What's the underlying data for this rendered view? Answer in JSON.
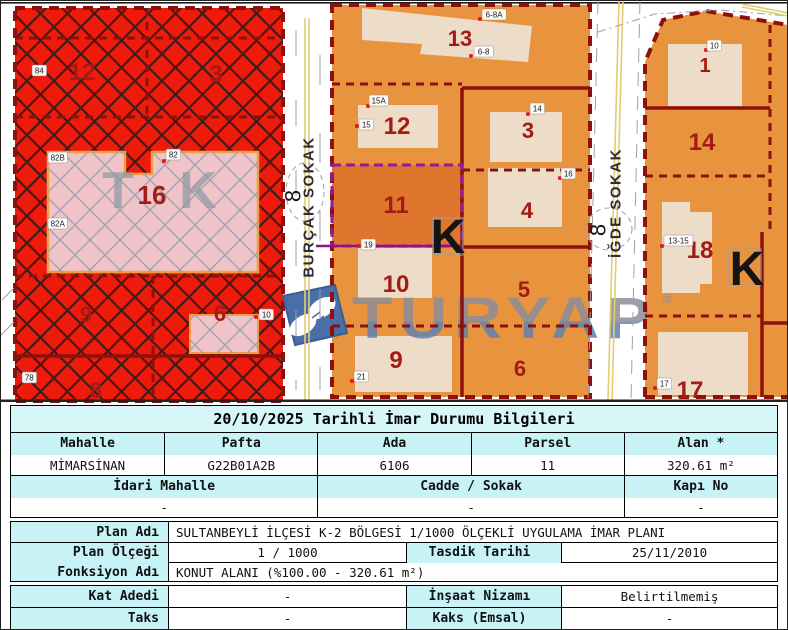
{
  "map": {
    "streets": [
      {
        "name": "BURÇAK SOKAK",
        "number": "8"
      },
      {
        "name": "İĞDE SOKAK",
        "number": "8"
      }
    ],
    "watermark": {
      "text": "TURYAP",
      "reg": "®"
    },
    "zone_letters": [
      {
        "t": "K",
        "x": 448,
        "y": 253,
        "s": 48,
        "c": "#141414",
        "o": 1
      },
      {
        "t": "K",
        "x": 747,
        "y": 285,
        "s": 48,
        "c": "#141414",
        "o": 1
      },
      {
        "t": "T",
        "x": 118,
        "y": 208,
        "s": 52,
        "c": "#8d97a3",
        "o": 0.7
      },
      {
        "t": "K",
        "x": 198,
        "y": 208,
        "s": 52,
        "c": "#8d97a3",
        "o": 0.7
      }
    ],
    "parcel_labels": [
      {
        "t": "12",
        "x": 82,
        "y": 80,
        "s": 24
      },
      {
        "t": "3",
        "x": 216,
        "y": 82,
        "s": 24
      },
      {
        "t": "16",
        "x": 152,
        "y": 204,
        "s": 26
      },
      {
        "t": "9",
        "x": 86,
        "y": 322,
        "s": 22
      },
      {
        "t": "6",
        "x": 220,
        "y": 321,
        "s": 22
      },
      {
        "t": "8",
        "x": 96,
        "y": 398,
        "s": 22
      },
      {
        "t": "13",
        "x": 460,
        "y": 46,
        "s": 22
      },
      {
        "t": "12",
        "x": 397,
        "y": 134,
        "s": 24
      },
      {
        "t": "3",
        "x": 528,
        "y": 138,
        "s": 22
      },
      {
        "t": "11",
        "x": 396,
        "y": 213,
        "s": 24
      },
      {
        "t": "4",
        "x": 527,
        "y": 218,
        "s": 22
      },
      {
        "t": "10",
        "x": 396,
        "y": 292,
        "s": 24
      },
      {
        "t": "5",
        "x": 524,
        "y": 297,
        "s": 22
      },
      {
        "t": "9",
        "x": 396,
        "y": 368,
        "s": 24
      },
      {
        "t": "6",
        "x": 520,
        "y": 376,
        "s": 22
      },
      {
        "t": "1",
        "x": 705,
        "y": 72,
        "s": 20
      },
      {
        "t": "14",
        "x": 702,
        "y": 150,
        "s": 24
      },
      {
        "t": "18",
        "x": 700,
        "y": 258,
        "s": 24
      },
      {
        "t": "17",
        "x": 690,
        "y": 398,
        "s": 24
      }
    ],
    "address_points": [
      {
        "t": "84",
        "x": 32,
        "y": 65
      },
      {
        "t": "82B",
        "x": 48,
        "y": 152
      },
      {
        "t": "82",
        "x": 166,
        "y": 149,
        "dot": [
          164,
          161
        ]
      },
      {
        "t": "82A",
        "x": 48,
        "y": 218
      },
      {
        "t": "78",
        "x": 22,
        "y": 372,
        "dot": [
          19,
          382
        ]
      },
      {
        "t": "10",
        "x": 259,
        "y": 309,
        "dot": [
          256,
          317
        ]
      },
      {
        "t": "6-8A",
        "x": 482,
        "y": 9,
        "dot": [
          480,
          19
        ]
      },
      {
        "t": "6-8",
        "x": 474,
        "y": 46,
        "dot": [
          471,
          56
        ]
      },
      {
        "t": "15A",
        "x": 369,
        "y": 95,
        "dot": [
          368,
          106
        ]
      },
      {
        "t": "15",
        "x": 359,
        "y": 119,
        "dot": [
          357,
          126
        ]
      },
      {
        "t": "14",
        "x": 530,
        "y": 103,
        "dot": [
          528,
          114
        ]
      },
      {
        "t": "16",
        "x": 561,
        "y": 168,
        "dot": [
          560,
          178
        ]
      },
      {
        "t": "19",
        "x": 361,
        "y": 239,
        "dot": [
          359,
          246
        ]
      },
      {
        "t": "21",
        "x": 354,
        "y": 371,
        "dot": [
          352,
          381
        ]
      },
      {
        "t": "10",
        "x": 707,
        "y": 40,
        "dot": [
          706,
          50
        ]
      },
      {
        "t": "13-15",
        "x": 664,
        "y": 235,
        "dot": [
          662,
          246
        ]
      },
      {
        "t": "17",
        "x": 657,
        "y": 378,
        "dot": [
          655,
          388
        ]
      }
    ],
    "colors": {
      "zone_red": "#ee1a0c",
      "zone_orange": "#e8943e",
      "selected_parcel_orange": "#e0762e",
      "building_beige": "#eddcc8",
      "pink_parcel": "#f0c3c9",
      "boundary_dark_red": "#8e100c",
      "selection_purple": "#97189c",
      "street_yellow": "#e3cc74",
      "watermark_grey": "#8e8e98",
      "watermark_blue": "#5f82b0",
      "table_header_cyan": "#c7f3f6"
    }
  },
  "table": {
    "title": "20/10/2025 Tarihli İmar Durumu Bilgileri",
    "cadastral": {
      "headers": [
        "Mahalle",
        "Pafta",
        "Ada",
        "Parsel",
        "Alan *"
      ],
      "values": [
        "MİMARSİNAN",
        "G22B01A2B",
        "6106",
        "11",
        "320.61 m²"
      ],
      "headers2": [
        "İdari Mahalle",
        "Cadde / Sokak",
        "Kapı No"
      ],
      "values2": [
        "-",
        "-",
        "-"
      ]
    },
    "plan": {
      "plan_adi_label": "Plan Adı",
      "plan_adi": "SULTANBEYLİ İLÇESİ K-2 BÖLGESİ 1/1000 ÖLÇEKLİ UYGULAMA İMAR PLANI",
      "plan_olcegi_label": "Plan Ölçeği",
      "plan_olcegi": "1 / 1000",
      "tasdik_label": "Tasdik Tarihi",
      "tasdik": "25/11/2010",
      "fonksiyon_label": "Fonksiyon Adı",
      "fonksiyon": "KONUT ALANI (%100.00 - 320.61 m²)"
    },
    "zoning": {
      "kat_adedi_label": "Kat Adedi",
      "kat_adedi": "-",
      "insaat_label": "İnşaat Nizamı",
      "insaat": "Belirtilmemiş",
      "taks_label": "Taks",
      "taks": "-",
      "kaks_label": "Kaks (Emsal)",
      "kaks": "-"
    }
  }
}
